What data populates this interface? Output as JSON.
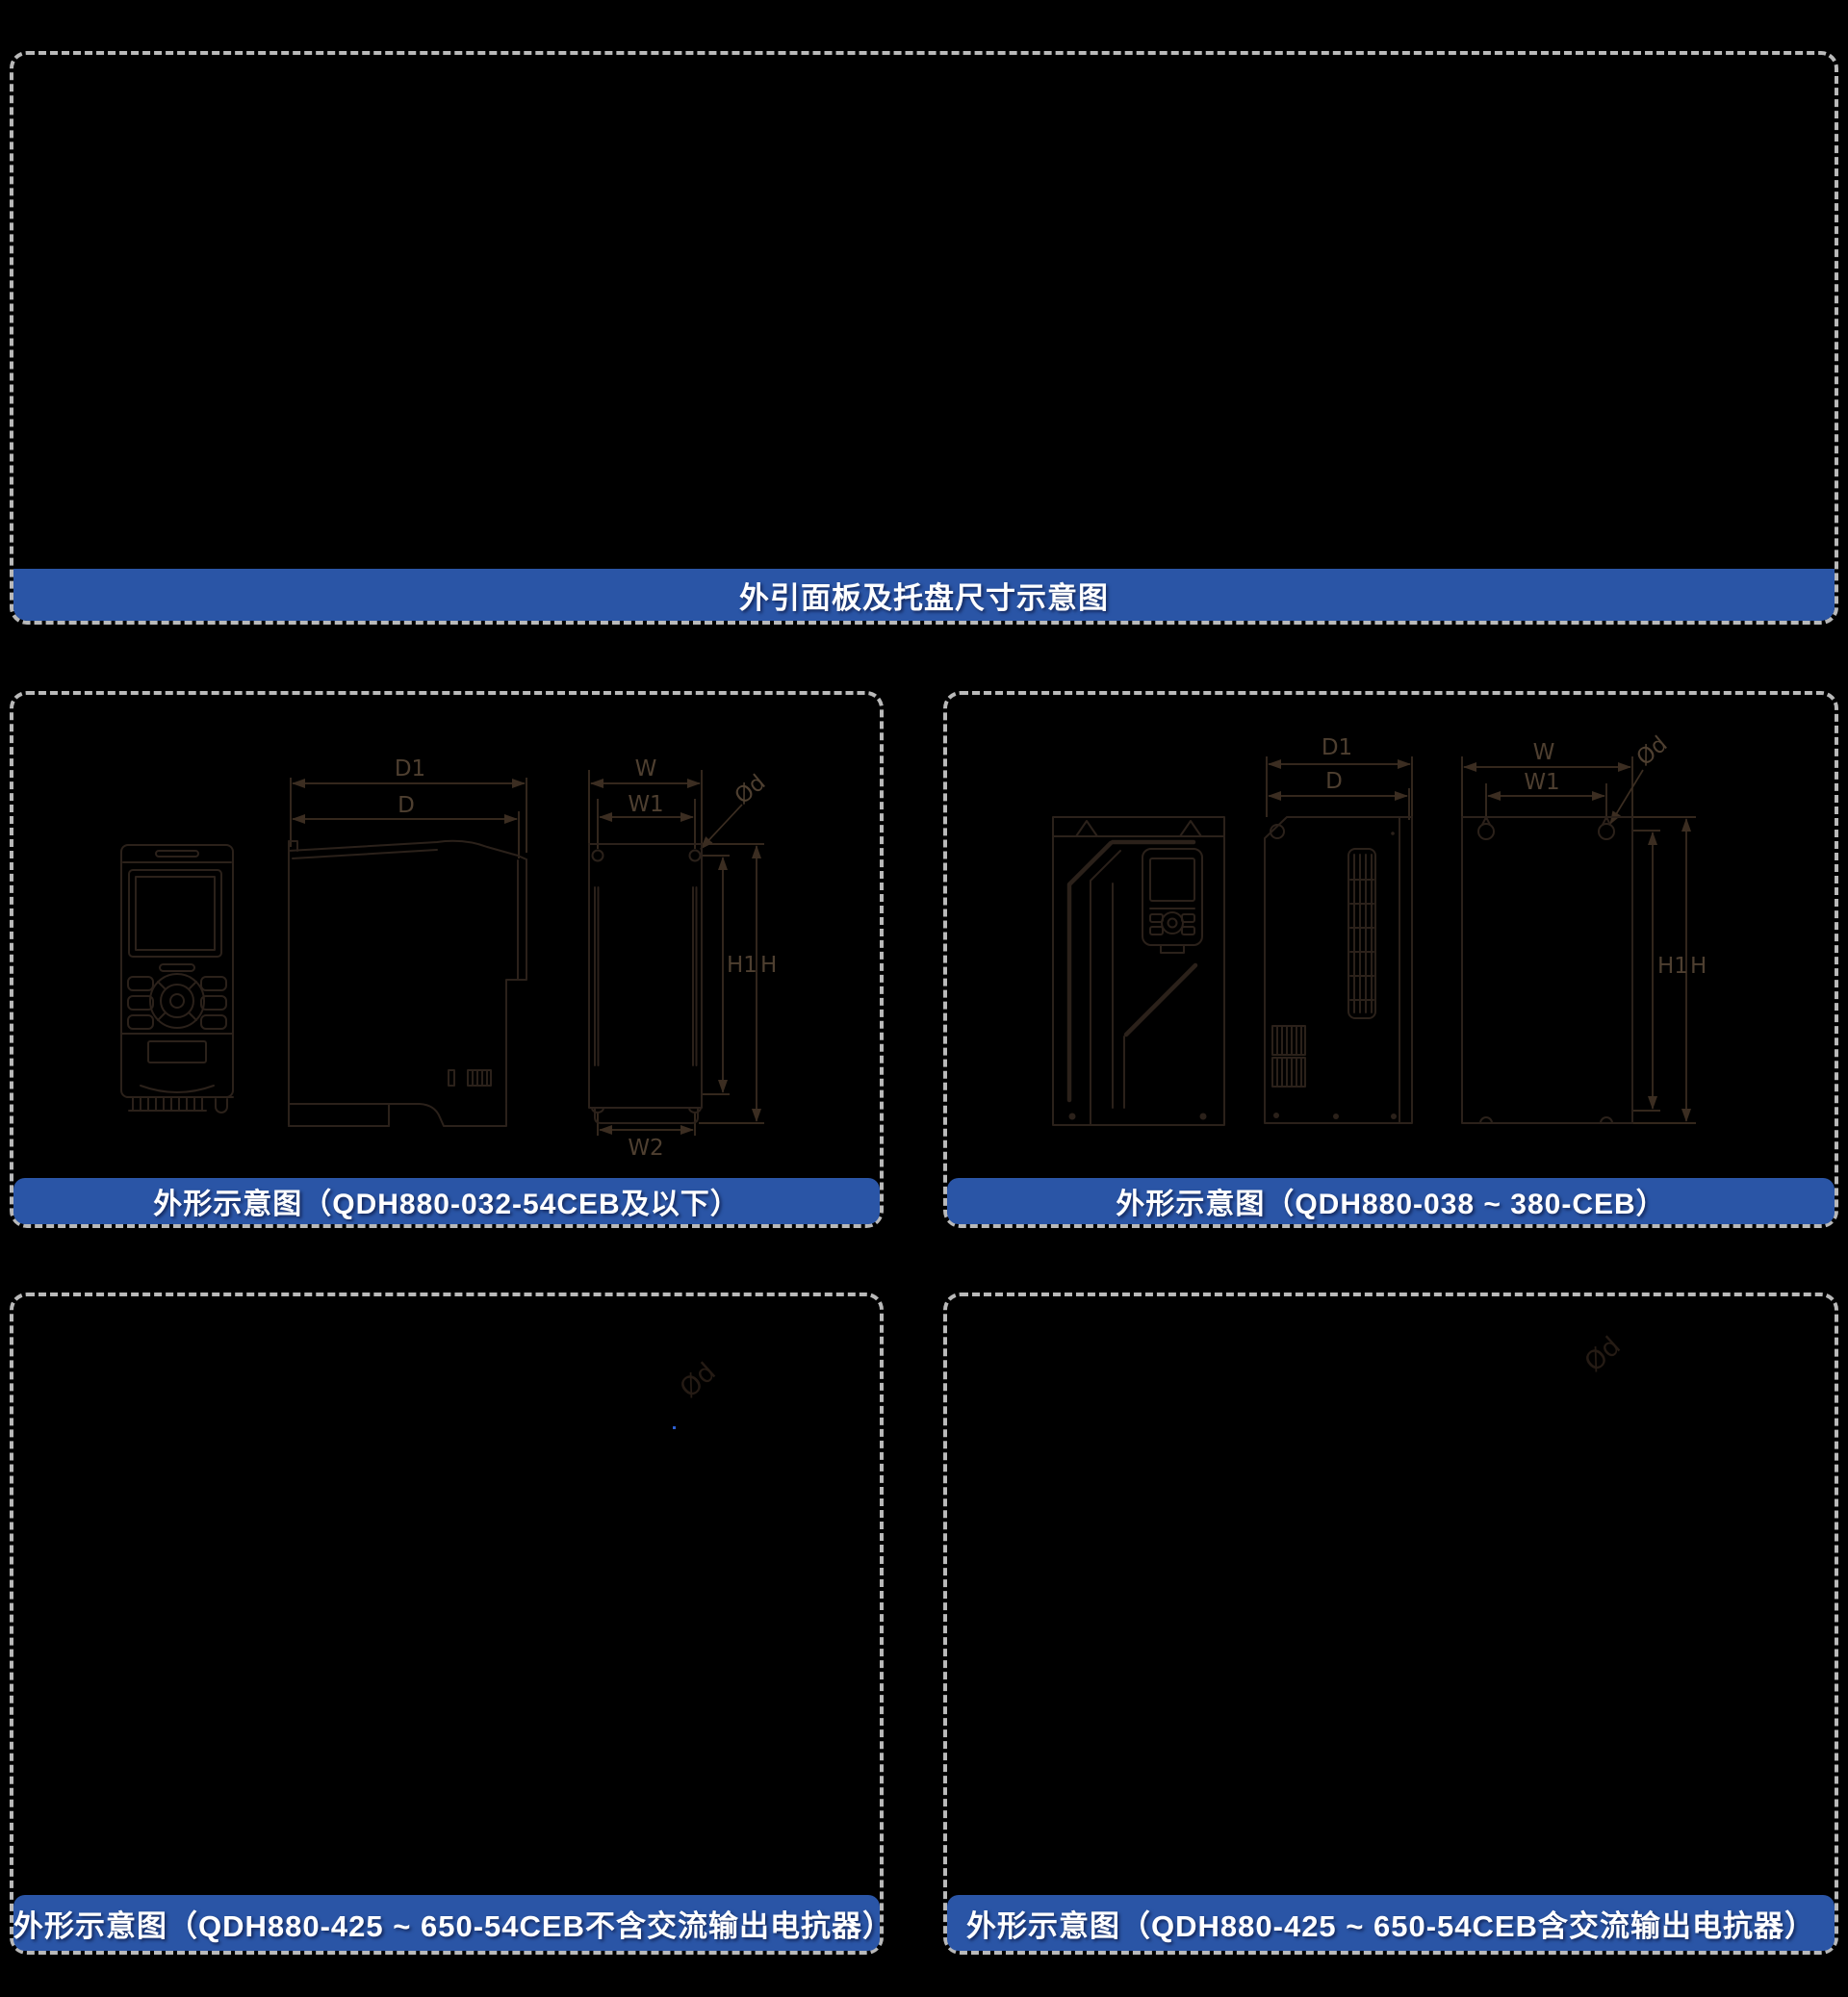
{
  "colors": {
    "background": "#000000",
    "dashed_border": "#b9b9b9",
    "banner_blue": "#2a55a6",
    "banner_text": "#ffffff",
    "drawing_line": "#2b211a",
    "drawing_label": "#4e3f30",
    "faint_label": "#251b14",
    "stray_speck_blue": "#2d5fd0"
  },
  "top_section": {
    "caption": "外引面板及托盘尺寸示意图"
  },
  "panels": {
    "mid_left": {
      "caption": "外形示意图（QDH880-032-54CEB及以下）",
      "dims": {
        "d1": "D1",
        "d": "D",
        "w": "W",
        "w1": "W1",
        "od": "Ød",
        "h1": "H1",
        "h": "H",
        "w2": "W2"
      }
    },
    "mid_right": {
      "caption": "外形示意图（QDH880-038 ~ 380-CEB）",
      "dims": {
        "d1": "D1",
        "d": "D",
        "w": "W",
        "w1": "W1",
        "od": "Ød",
        "h1": "H1",
        "h": "H"
      }
    },
    "bottom_left": {
      "caption": "外形示意图（QDH880-425 ~ 650-54CEB不含交流输出电抗器）",
      "dims": {
        "od": "Ød"
      }
    },
    "bottom_right": {
      "caption": "外形示意图（QDH880-425 ~ 650-54CEB含交流输出电抗器）",
      "dims": {
        "od": "Ød"
      }
    }
  }
}
